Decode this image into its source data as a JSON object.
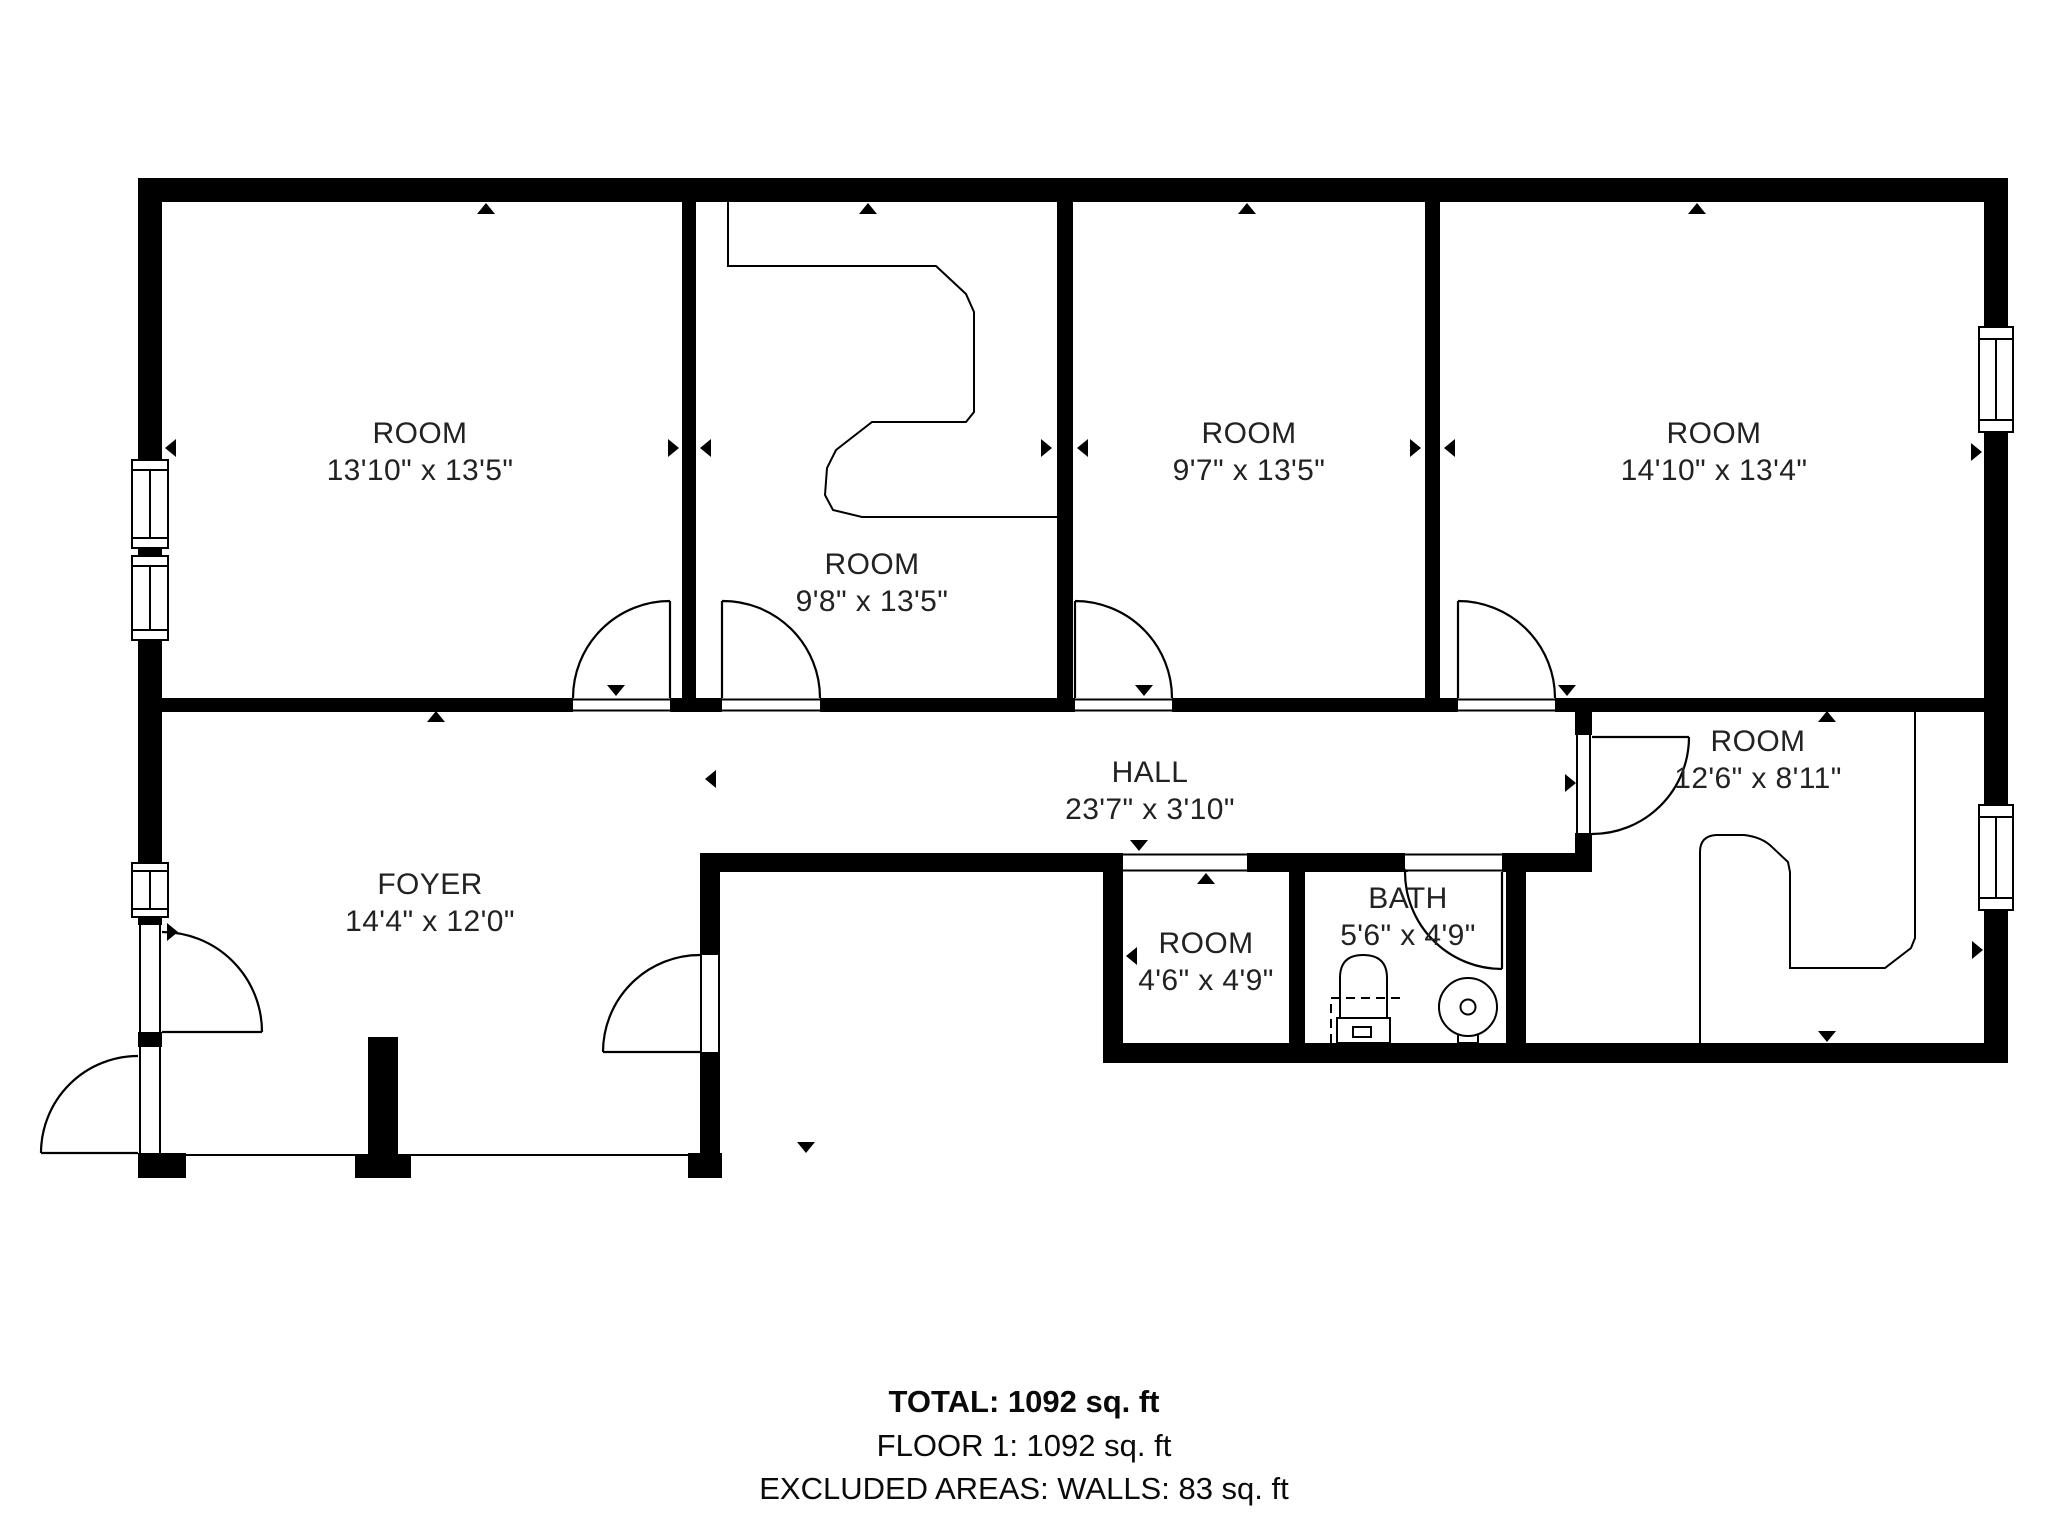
{
  "rooms": [
    {
      "id": "room-1",
      "name": "ROOM",
      "dims": "13'10\" x 13'5\""
    },
    {
      "id": "room-2",
      "name": "ROOM",
      "dims": "9'8\" x 13'5\""
    },
    {
      "id": "room-3",
      "name": "ROOM",
      "dims": "9'7\" x 13'5\""
    },
    {
      "id": "room-4",
      "name": "ROOM",
      "dims": "14'10\" x 13'4\""
    },
    {
      "id": "hall",
      "name": "HALL",
      "dims": "23'7\" x 3'10\""
    },
    {
      "id": "foyer",
      "name": "FOYER",
      "dims": "14'4\" x 12'0\""
    },
    {
      "id": "room-small",
      "name": "ROOM",
      "dims": "4'6\" x 4'9\""
    },
    {
      "id": "bath",
      "name": "BATH",
      "dims": "5'6\" x 4'9\""
    },
    {
      "id": "room-right",
      "name": "ROOM",
      "dims": "12'6\" x 8'11\""
    }
  ],
  "summary": {
    "total": "TOTAL: 1092 sq. ft",
    "floor": "FLOOR 1: 1092 sq. ft",
    "excluded": "EXCLUDED AREAS: WALLS: 83 sq. ft",
    "disclaimer": "FLOOR PLAN CREATED BY CUBICASA APP. MEASUREMENTS DEEMED HIGHLY RELIABLE BUT NOT GUARANTEED."
  },
  "colors": {
    "wall": "#000000",
    "background": "#ffffff",
    "label_text": "#222222"
  },
  "icons": [
    "window-icon",
    "door-swing-icon",
    "doorway-opening-icon",
    "toilet-icon",
    "sink-icon",
    "closet-outline-icon",
    "counter-outline-icon",
    "wall-marker-icon",
    "pillar-icon"
  ]
}
